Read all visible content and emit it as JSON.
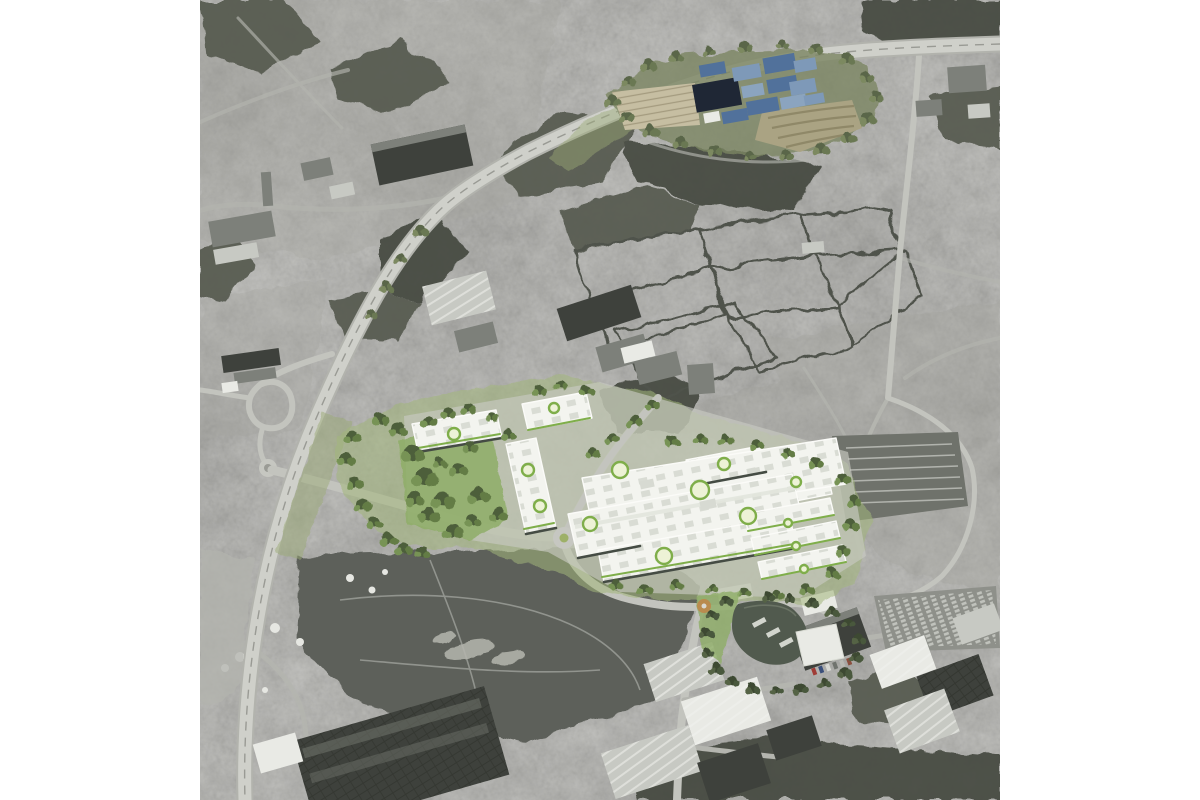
{
  "scene": {
    "description": "Oblique grayscale aerial photograph with a coloured CGI overlay of a proposed logistics park in the centre (white roofs, green landscaping), a blue-toned campus render at the top right, a curving motorway on the left, farm fields, woodland, suburbs and industrial estates, with plain white margins on the left and right edges.",
    "photo_area": {
      "left": 200,
      "top": 0,
      "width": 800,
      "height": 800
    }
  },
  "colors": {
    "photo-base": "#98988f",
    "woods": "#565a50",
    "woods-dark": "#44483f",
    "field-dark": "#6e706a",
    "field-mid": "#868882",
    "field-light": "#9c9e98",
    "field-pale": "#a8a9a3",
    "hedgerow": "#4f524b",
    "road": "#c3c4be",
    "road-minor": "#b4b5af",
    "highway-edge": "#b2b3ad",
    "highway": "#cfd0ca",
    "highway-median": "#999a94",
    "bldg-dark": "#3e413c",
    "bldg-mid": "#7d807a",
    "bldg-light": "#c7c9c3",
    "bldg-white": "#e9eae5",
    "car-yard": "#6f726b",
    "chalk": "#b5b6ae",
    "brownfield": "#5d605a",
    "pale-verge": "#b3b4ae",
    "dev-landscape": "#a3b77c",
    "dev-apron": "#c8c9c2",
    "dev-grass": "#8fae68",
    "dev-verge": "#9cab77",
    "dev-roof": "#f3f4ef",
    "dev-roof-edge": "#fbfbf8",
    "dev-skylight": "#d7dad2",
    "dev-facade": "#454c44",
    "accent-green": "#7fae4a",
    "logo-center": "#edf2d6",
    "tree-green-1": "#4d5e3a",
    "tree-green-2": "#637c45",
    "tree-green-3": "#779355",
    "campus-ground": "#7c8663",
    "campus-parking": "#c6bea2",
    "campus-parking-line": "#a49b7f",
    "campus-terrace": "#aaa383",
    "campus-terrace-line": "#8f8868",
    "campus-navy": "#1f2735",
    "campus-blue": "#51719b",
    "campus-blue-light": "#7e99b8",
    "campus-blue-pale": "#8ba4bf",
    "annex-roof": "#515a4e",
    "annex-roundabout": "#c08548"
  }
}
